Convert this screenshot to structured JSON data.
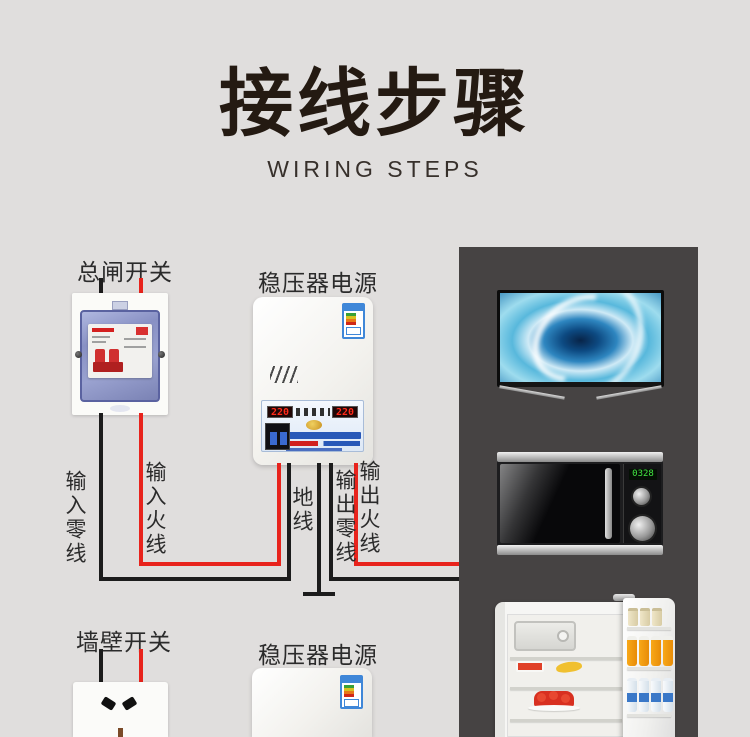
{
  "header": {
    "title": "接线步骤",
    "subtitle": "WIRING STEPS"
  },
  "labels": {
    "main_breaker": "总闸开关",
    "stabilizer_top": "稳压器电源",
    "wall_switch": "墙壁开关",
    "stabilizer_bottom": "稳压器电源"
  },
  "wires": {
    "input_neutral": "输入零线",
    "input_live": "输入火线",
    "ground": "地线",
    "output_neutral": "输出零线",
    "output_live": "输出火线"
  },
  "stabilizer_panel": {
    "input_voltage": "220",
    "output_voltage": "220"
  },
  "microwave": {
    "display": "0328"
  },
  "appliances": [
    "tv",
    "microwave",
    "refrigerator"
  ],
  "colors": {
    "background": "#e0dedd",
    "panel": "#464343",
    "live_wire": "#e8231c",
    "neutral_wire": "#1c1c1c",
    "title": "#241a12",
    "sticker_blue": "#3f87d8"
  }
}
